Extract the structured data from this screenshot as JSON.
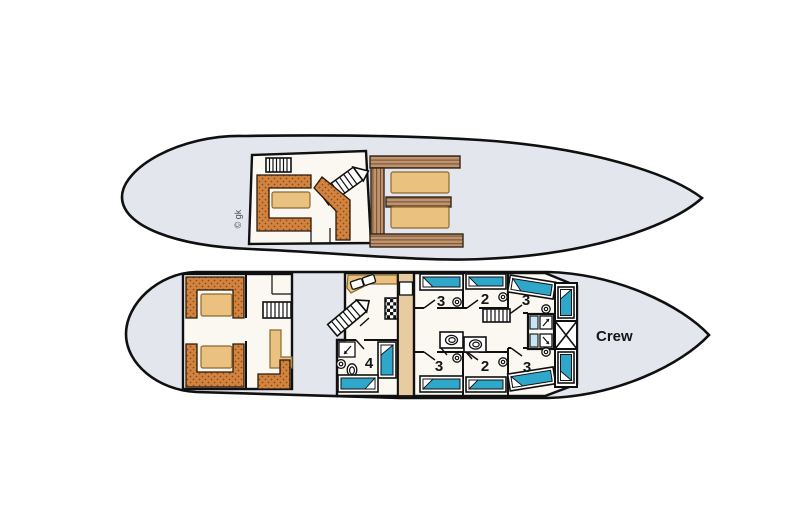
{
  "labels": {
    "copyright": "© gk",
    "crew": "Crew"
  },
  "cabins": {
    "top_row": [
      "3",
      "2",
      "3"
    ],
    "bottom_row": [
      "3",
      "2",
      "3"
    ],
    "quad": "4"
  },
  "colors": {
    "hull": "#E4E6EE",
    "floor": "#FAF8F1",
    "wall": "#101010",
    "ink": "#161616",
    "bench": "#D2843F",
    "bench_dot": "#8A4A1E",
    "wood": "#C2936B",
    "wood_line": "#5F4833",
    "table": "#EAC17E",
    "table_edge": "#8A6A33",
    "corridor": "#E7CBA1",
    "bed": "#2EA7CB",
    "shower_panel": "#C4E5F1"
  },
  "icons": {
    "stairs": "hatched-band",
    "shower": "square-with-diagonal-arrow",
    "toilet": "oval",
    "sink": "circle",
    "stove": "checker-grid",
    "storage_hatch": "crossed-box",
    "bed": "teal-mattress-with-pillow",
    "sofa": "dotted-upholstery",
    "deck_bench": "wood-slats",
    "table": "tan-rounded-rect"
  }
}
